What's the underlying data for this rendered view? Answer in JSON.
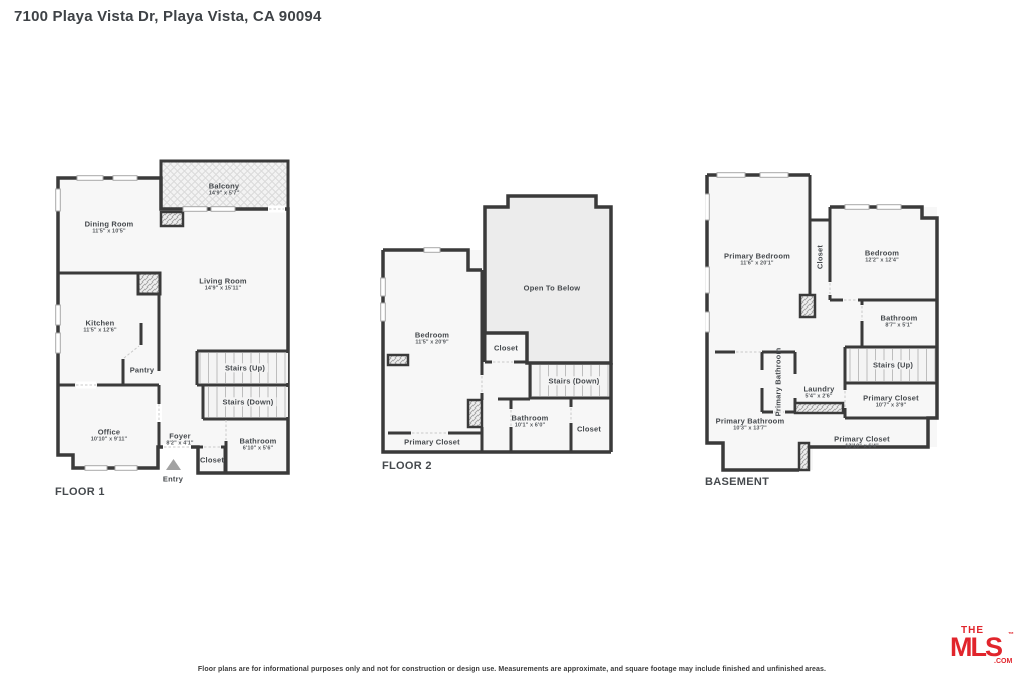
{
  "page": {
    "title": "7100 Playa Vista Dr, Playa Vista, CA 90094",
    "disclaimer": "Floor plans are for informational purposes only and not for construction or design use. Measurements are approximate, and square footage may include finished and unfinished areas.",
    "colors": {
      "wall": "#3a3a3a",
      "room_fill": "#f7f7f7",
      "open_fill": "#ececec",
      "logo_red": "#e1252c",
      "label_text": "#44484c"
    },
    "logo": {
      "the": "THE",
      "mls": "MLS",
      "tm": "™",
      "com": ".COM"
    }
  },
  "floor1": {
    "label": "FLOOR 1",
    "rooms": {
      "balcony": {
        "name": "Balcony",
        "dims": "14'9\" x 5'7\""
      },
      "dining": {
        "name": "Dining Room",
        "dims": "11'5\" x 10'5\""
      },
      "living": {
        "name": "Living Room",
        "dims": "14'9\" x 15'11\""
      },
      "kitchen": {
        "name": "Kitchen",
        "dims": "11'5\" x 12'6\""
      },
      "pantry": {
        "name": "Pantry"
      },
      "office": {
        "name": "Office",
        "dims": "10'10\" x 9'11\""
      },
      "foyer": {
        "name": "Foyer",
        "dims": "8'2\" x 4'1\""
      },
      "closet": {
        "name": "Closet"
      },
      "bathroom": {
        "name": "Bathroom",
        "dims": "6'10\" x 5'6\""
      },
      "stairs_up": {
        "name": "Stairs (Up)"
      },
      "stairs_down": {
        "name": "Stairs (Down)"
      },
      "entry": {
        "name": "Entry"
      }
    }
  },
  "floor2": {
    "label": "FLOOR 2",
    "rooms": {
      "open_to_below": {
        "name": "Open To Below"
      },
      "bedroom": {
        "name": "Bedroom",
        "dims": "11'5\" x 20'9\""
      },
      "closet": {
        "name": "Closet"
      },
      "stairs_down": {
        "name": "Stairs (Down)"
      },
      "bathroom": {
        "name": "Bathroom",
        "dims": "10'1\" x 6'0\""
      },
      "closet2": {
        "name": "Closet"
      },
      "primary_closet": {
        "name": "Primary Closet"
      }
    }
  },
  "basement": {
    "label": "BASEMENT",
    "rooms": {
      "primary_bedroom": {
        "name": "Primary Bedroom",
        "dims": "11'6\" x 20'1\""
      },
      "closet": {
        "name": "Closet"
      },
      "bedroom": {
        "name": "Bedroom",
        "dims": "12'2\" x 12'4\""
      },
      "bathroom": {
        "name": "Bathroom",
        "dims": "8'7\" x 5'1\""
      },
      "stairs_up": {
        "name": "Stairs (Up)"
      },
      "primary_closet_upper": {
        "name": "Primary Closet",
        "dims": "10'7\" x 3'9\""
      },
      "laundry": {
        "name": "Laundry",
        "dims": "5'4\" x 2'6\""
      },
      "primary_bathroom_small": {
        "name": "Primary Bathroom"
      },
      "primary_bathroom": {
        "name": "Primary Bathroom",
        "dims": "10'3\" x 13'7\""
      },
      "primary_closet_lower": {
        "name": "Primary Closet",
        "dims": "13'10\" x 6'4\""
      }
    }
  }
}
